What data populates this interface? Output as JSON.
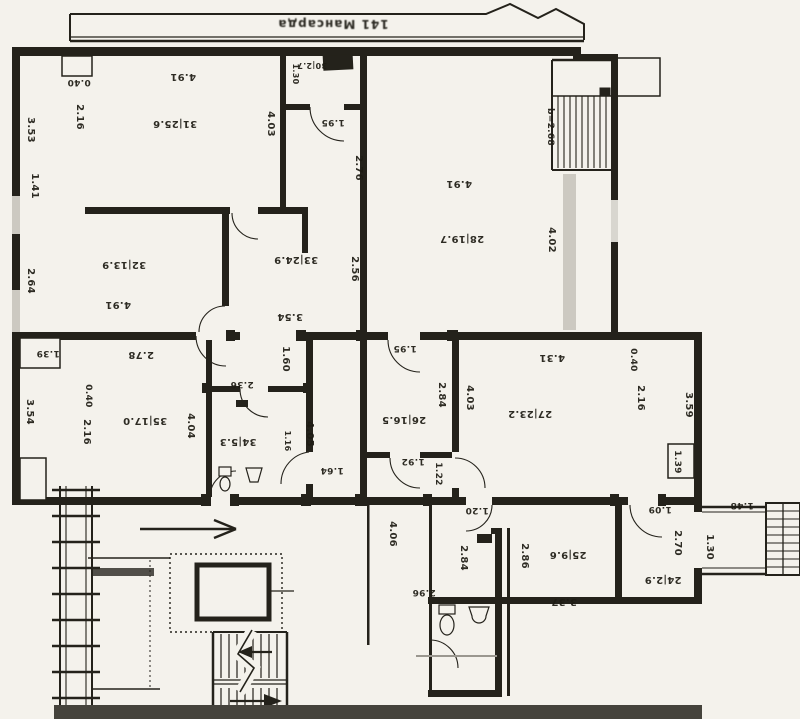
{
  "sheet": {
    "title": "141 Мансарда"
  },
  "colors": {
    "ink": "#24221b",
    "paper": "#f4f2ec",
    "scan_gray": "#ccc9c1",
    "bottom_band": "#45433c"
  },
  "rooms": [
    {
      "num": "31",
      "area": "25.6",
      "x": 175,
      "y": 121
    },
    {
      "num": "30",
      "area": "2.7",
      "x": 312,
      "y": 63,
      "s": 8
    },
    {
      "num": "28",
      "area": "19.7",
      "x": 462,
      "y": 236
    },
    {
      "num": "33",
      "area": "24.9",
      "x": 296,
      "y": 257
    },
    {
      "num": "32",
      "area": "13.9",
      "x": 124,
      "y": 262
    },
    {
      "num": "35",
      "area": "17.0",
      "x": 145,
      "y": 418
    },
    {
      "num": "34",
      "area": "5.3",
      "x": 238,
      "y": 439
    },
    {
      "num": "26",
      "area": "16.5",
      "x": 404,
      "y": 417
    },
    {
      "num": "27",
      "area": "23.2",
      "x": 530,
      "y": 411
    },
    {
      "num": "25",
      "area": "9.6",
      "x": 568,
      "y": 552
    },
    {
      "num": "24",
      "area": "2.9",
      "x": 663,
      "y": 577
    }
  ],
  "dims": [
    {
      "t": "0.40",
      "x": 79,
      "y": 80,
      "r": 180,
      "s": 9
    },
    {
      "t": "4.91",
      "x": 183,
      "y": 74,
      "r": 180,
      "s": 10
    },
    {
      "t": "2.16",
      "x": 77,
      "y": 117,
      "r": 90,
      "s": 10
    },
    {
      "t": "3.53",
      "x": 28,
      "y": 130,
      "r": 90,
      "s": 10
    },
    {
      "t": "1.41",
      "x": 32,
      "y": 186,
      "r": 90,
      "s": 10
    },
    {
      "t": "4.03",
      "x": 268,
      "y": 124,
      "r": 90,
      "s": 10
    },
    {
      "t": "1.30",
      "x": 293,
      "y": 74,
      "r": 90,
      "s": 8
    },
    {
      "t": "1.95",
      "x": 333,
      "y": 120,
      "r": 180,
      "s": 9
    },
    {
      "t": "2.76",
      "x": 356,
      "y": 168,
      "r": 90,
      "s": 10
    },
    {
      "t": "4.91",
      "x": 459,
      "y": 181,
      "r": 180,
      "s": 10
    },
    {
      "t": "b=2.68",
      "x": 548,
      "y": 127,
      "r": 90,
      "s": 9
    },
    {
      "t": "4.02",
      "x": 549,
      "y": 240,
      "r": 90,
      "s": 10
    },
    {
      "t": "2.56",
      "x": 352,
      "y": 269,
      "r": 90,
      "s": 10
    },
    {
      "t": "3.54",
      "x": 290,
      "y": 314,
      "r": 180,
      "s": 10
    },
    {
      "t": "4.91",
      "x": 118,
      "y": 302,
      "r": 180,
      "s": 10
    },
    {
      "t": "2.64",
      "x": 28,
      "y": 281,
      "r": 90,
      "s": 10
    },
    {
      "t": "2.78",
      "x": 141,
      "y": 352,
      "r": 180,
      "s": 10
    },
    {
      "t": "1.39",
      "x": 48,
      "y": 351,
      "r": 180,
      "s": 9
    },
    {
      "t": "0.40",
      "x": 86,
      "y": 396,
      "r": 90,
      "s": 9
    },
    {
      "t": "3.54",
      "x": 27,
      "y": 412,
      "r": 90,
      "s": 10
    },
    {
      "t": "2.16",
      "x": 84,
      "y": 432,
      "r": 90,
      "s": 10
    },
    {
      "t": "4.04",
      "x": 188,
      "y": 426,
      "r": 90,
      "s": 10
    },
    {
      "t": "1.60",
      "x": 283,
      "y": 359,
      "r": 90,
      "s": 10
    },
    {
      "t": "2.36",
      "x": 242,
      "y": 382,
      "r": 180,
      "s": 9
    },
    {
      "t": "1.16",
      "x": 285,
      "y": 441,
      "r": 90,
      "s": 8
    },
    {
      "t": "4.05",
      "x": 307,
      "y": 434,
      "r": 90,
      "s": 10
    },
    {
      "t": "1.64",
      "x": 332,
      "y": 468,
      "r": 180,
      "s": 9
    },
    {
      "t": "1.95",
      "x": 405,
      "y": 346,
      "r": 180,
      "s": 9
    },
    {
      "t": "2.84",
      "x": 439,
      "y": 395,
      "r": 90,
      "s": 10
    },
    {
      "t": "4.03",
      "x": 467,
      "y": 398,
      "r": 90,
      "s": 10
    },
    {
      "t": "1.92",
      "x": 413,
      "y": 459,
      "r": 180,
      "s": 9
    },
    {
      "t": "1.22",
      "x": 436,
      "y": 474,
      "r": 90,
      "s": 9
    },
    {
      "t": "4.31",
      "x": 552,
      "y": 355,
      "r": 180,
      "s": 10
    },
    {
      "t": "0.40",
      "x": 631,
      "y": 360,
      "r": 90,
      "s": 9
    },
    {
      "t": "2.16",
      "x": 638,
      "y": 398,
      "r": 90,
      "s": 10
    },
    {
      "t": "3.59",
      "x": 686,
      "y": 405,
      "r": 90,
      "s": 10
    },
    {
      "t": "1.39",
      "x": 675,
      "y": 462,
      "r": 90,
      "s": 9
    },
    {
      "t": "4.06",
      "x": 390,
      "y": 534,
      "r": 90,
      "s": 10
    },
    {
      "t": "1.20",
      "x": 477,
      "y": 508,
      "r": 180,
      "s": 9
    },
    {
      "t": "2.84",
      "x": 461,
      "y": 558,
      "r": 90,
      "s": 10
    },
    {
      "t": "2.86",
      "x": 522,
      "y": 556,
      "r": 90,
      "s": 10
    },
    {
      "t": "2.96",
      "x": 424,
      "y": 590,
      "r": 180,
      "s": 9
    },
    {
      "t": "3.37",
      "x": 564,
      "y": 599,
      "r": 180,
      "s": 10
    },
    {
      "t": "1.09",
      "x": 660,
      "y": 507,
      "r": 180,
      "s": 9
    },
    {
      "t": "2.70",
      "x": 675,
      "y": 543,
      "r": 90,
      "s": 10
    },
    {
      "t": "1.30",
      "x": 707,
      "y": 547,
      "r": 90,
      "s": 10
    },
    {
      "t": "1.48",
      "x": 742,
      "y": 503,
      "r": 180,
      "s": 9
    }
  ]
}
